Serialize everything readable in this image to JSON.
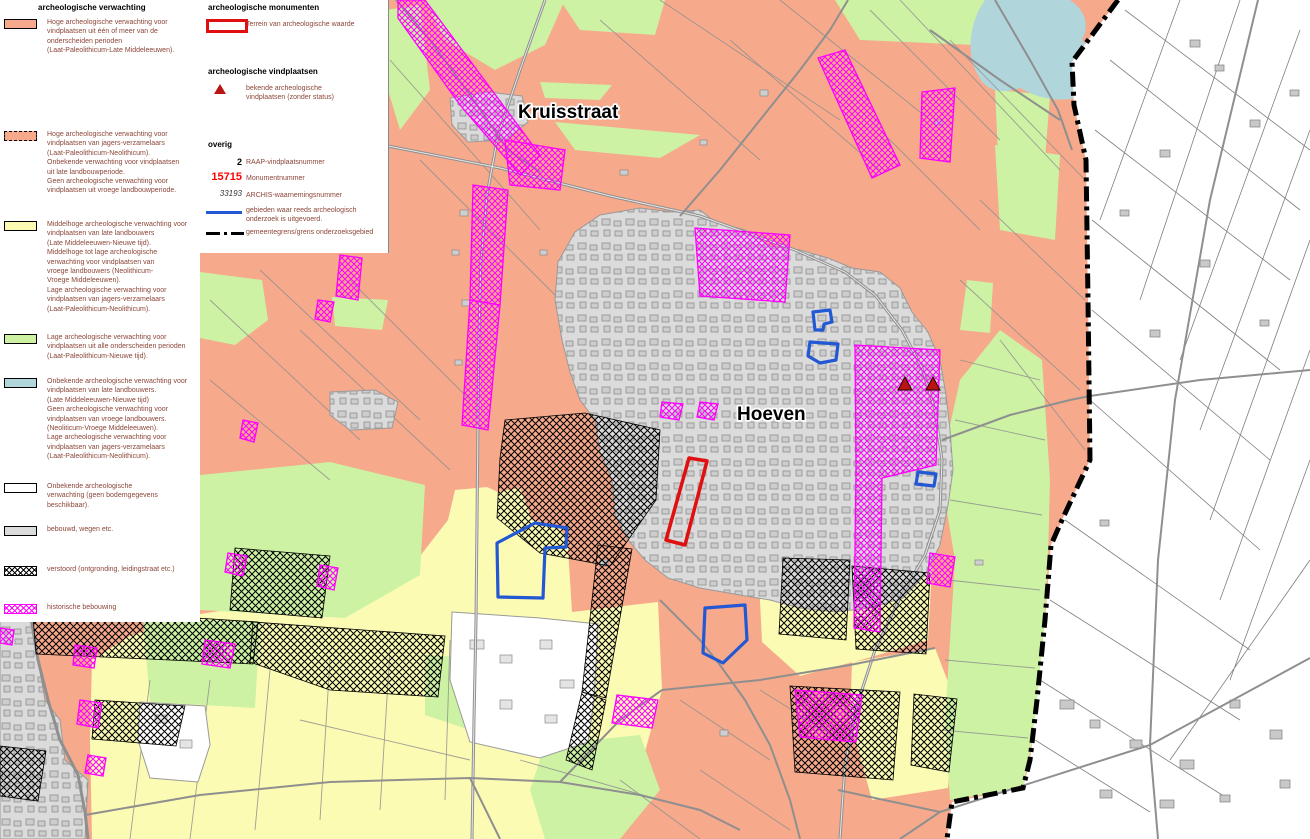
{
  "map": {
    "labels": {
      "town_north": "Kruisstraat",
      "town_center": "Hoeven"
    }
  },
  "legend_verwachting": {
    "title": "archeologische verwachting",
    "items": [
      {
        "name": "hoge-verwachting",
        "swatch": "salmon-solid",
        "text": "Hoge archeologische verwachting voor\nvindplaatsen uit één of meer van de\nonderscheiden perioden\n(Laat-Paleolithicum-Late Middeleeuwen)."
      },
      {
        "name": "hoge-verwachting-jagers",
        "swatch": "salmon-dashed",
        "text": "Hoge archeologische verwachting voor\nvindplaatsen van jagers-verzamelaars\n(Laat-Paleolithicum-Neolithicum).\nOnbekende verwachting voor vindplaatsen\nuit late landbouwperiode.\nGeen archeologische verwachting voor\nvindplaatsen uit vroege landbouwperiode."
      },
      {
        "name": "middelhoge-verwachting",
        "swatch": "yellow-solid",
        "text": "Middelhoge archeologische verwachting voor\nvindplaatsen van late landbouwers\n(Late Middeleeuwen-Nieuwe tijd).\nMiddelhoge tot lage archeologische\nverwachting voor vindplaatsen van\nvroege landbouwers (Neolithicum-\nVroege Middeleeuwen).\nLage archeologische verwachting voor\nvindplaatsen van jagers-verzamelaars\n(Laat-Paleolithicum-Neolithicum)."
      },
      {
        "name": "lage-verwachting",
        "swatch": "green-solid",
        "text": "Lage archeologische verwachting voor\nvindplaatsen uit alle onderscheiden perioden\n(Laat-Paleolithicum-Nieuwe tijd)."
      },
      {
        "name": "onbekende-verwachting-landbouwers",
        "swatch": "blue-solid",
        "text": "Onbekende archeologische verwachting voor\nvindplaatsen van late landbouwers.\n(Late Middeleeuwen-Nieuwe tijd)\nGeen archeologische verwachting voor\nvindplaatsen van vroege landbouwers.\n(Neoliticum-Vroege Middeleeuwen).\nLage archeologische verwachting voor\nvindplaatsen van jagers-verzamelaars\n(Laat-Paleolithicum-Neolithicum)."
      },
      {
        "name": "onbekende-verwachting",
        "swatch": "white-solid",
        "text": "Onbekende archeologische\nverwachting (geen bodemgegevens\nbeschikbaar)."
      },
      {
        "name": "bebouwd",
        "swatch": "gray-solid",
        "text": "bebouwd, wegen etc."
      },
      {
        "name": "verstoord",
        "swatch": "black-hatch",
        "text": "verstoord (ontgronding, leidingstraat etc.)"
      },
      {
        "name": "historische-bebouwing",
        "swatch": "magenta-hatch",
        "text": "historische bebouwing"
      }
    ]
  },
  "legend_monumenten": {
    "title": "archeologische monumenten",
    "item": {
      "swatch": "red-outline",
      "text": "Terrein van archeologische waarde"
    }
  },
  "legend_vindplaatsen": {
    "title": "archeologische vindplaatsen",
    "item": {
      "swatch": "red-triangle",
      "text": "bekende archeologische\nvindplaatsen (zonder status)"
    }
  },
  "legend_overig": {
    "title": "overig",
    "items": [
      {
        "symbol": "2",
        "style": "bold-black",
        "text": "RAAP-vindplaatsnummer"
      },
      {
        "symbol": "15715",
        "style": "bold-red",
        "text": "Monumentnummer"
      },
      {
        "symbol": "33193",
        "style": "italic",
        "text": "ARCHIS-waarnemingsnummer"
      },
      {
        "symbol": "blue-line",
        "text": "gebieden waar reeds archeologisch\nonderzoek is uitgevoerd."
      },
      {
        "symbol": "dash-dot-line",
        "text": "gemeentegrens/grens onderzoeksgebied"
      }
    ]
  },
  "colors": {
    "high_expectation": "#f6a98b",
    "medium_expectation": "#fbfbb4",
    "low_expectation": "#cdf2a4",
    "unknown_late_farmers": "#b0d6dc",
    "built_up": "#dbdbdb",
    "historic_hatch": "#ff00ff",
    "research_outline": "#2258d4",
    "monument_outline": "#e01010",
    "find_marker": "#b81414",
    "boundary": "#000000"
  }
}
